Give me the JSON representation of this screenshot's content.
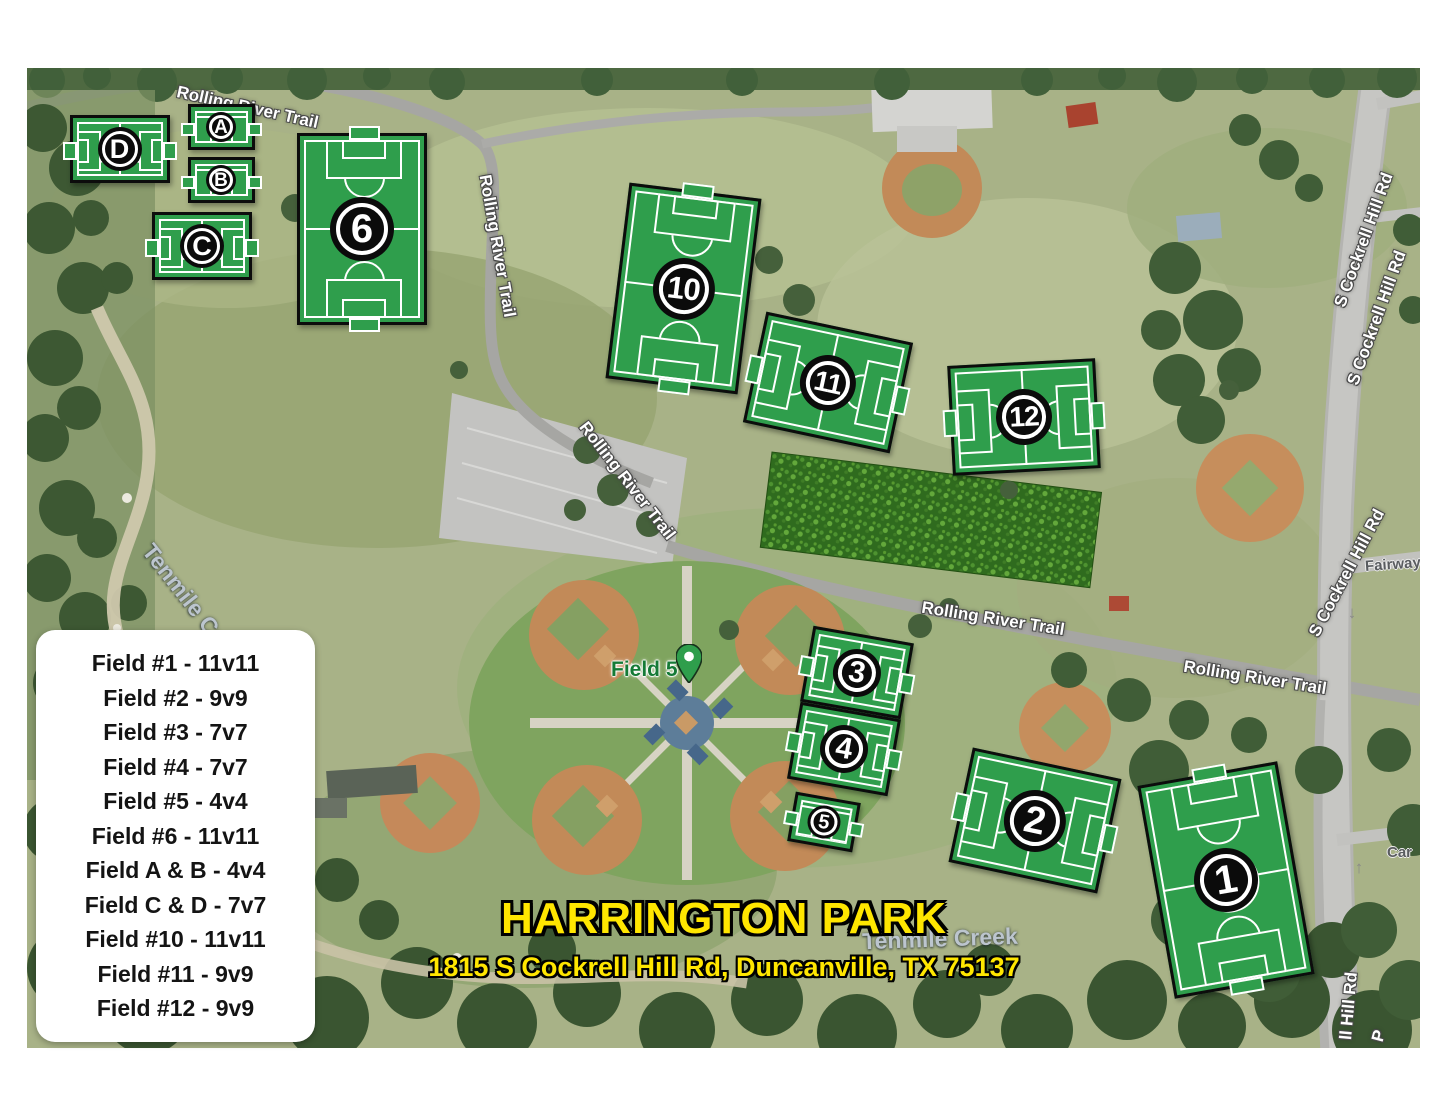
{
  "title": {
    "park_name": "HARRINGTON PARK",
    "address": "1815 S Cockrell Hill Rd, Duncanville, TX 75137"
  },
  "legend": {
    "items": [
      "Field #1 - 11v11",
      "Field #2 - 9v9",
      "Field #3 - 7v7",
      "Field #4 - 7v7",
      "Field #5 - 4v4",
      "Field #6 - 11v11",
      "Field A & B - 4v4",
      "Field C & D - 7v7",
      "Field #10 - 11v11",
      "Field #11 - 9v9",
      "Field #12 - 9v9"
    ]
  },
  "fields": [
    {
      "id": "D",
      "label": "D"
    },
    {
      "id": "A",
      "label": "A"
    },
    {
      "id": "B",
      "label": "B"
    },
    {
      "id": "C",
      "label": "C"
    },
    {
      "id": "6",
      "label": "6"
    },
    {
      "id": "10",
      "label": "10"
    },
    {
      "id": "11",
      "label": "11"
    },
    {
      "id": "12",
      "label": "12"
    },
    {
      "id": "3",
      "label": "3"
    },
    {
      "id": "4",
      "label": "4"
    },
    {
      "id": "5",
      "label": "5"
    },
    {
      "id": "2",
      "label": "2"
    },
    {
      "id": "1",
      "label": "1"
    }
  ],
  "map_labels": [
    {
      "id": "trail-top",
      "text": "Rolling River Trail"
    },
    {
      "id": "trail-west",
      "text": "Rolling River Trail"
    },
    {
      "id": "trail-diagonal",
      "text": "Rolling River Trail"
    },
    {
      "id": "trail-mid",
      "text": "Rolling River Trail"
    },
    {
      "id": "trail-east",
      "text": "Rolling River Trail"
    },
    {
      "id": "cockrell-north-1",
      "text": "S Cockrell Hill Rd"
    },
    {
      "id": "cockrell-north-2",
      "text": "S Cockrell Hill Rd"
    },
    {
      "id": "cockrell-mid",
      "text": "S Cockrell Hill Rd"
    },
    {
      "id": "hill-rd-south",
      "text": "ll Hill Rd"
    },
    {
      "id": "p-partial",
      "text": "P"
    },
    {
      "id": "fairway",
      "text": "Fairway"
    },
    {
      "id": "car-street",
      "text": "Car"
    },
    {
      "id": "creek-east",
      "text": "Tenmile Creek"
    },
    {
      "id": "creek-west",
      "text": "Tenmile Creek"
    },
    {
      "id": "field5-poi",
      "text": "Field 5"
    },
    {
      "id": "road-arrow-down",
      "text": "↓"
    },
    {
      "id": "road-arrow-up",
      "text": "↑"
    }
  ],
  "colors": {
    "field_green": "#2f9e4c",
    "badge_black": "#0b0b0b",
    "line_white": "#ffffff",
    "title_yellow": "#ffe600"
  }
}
